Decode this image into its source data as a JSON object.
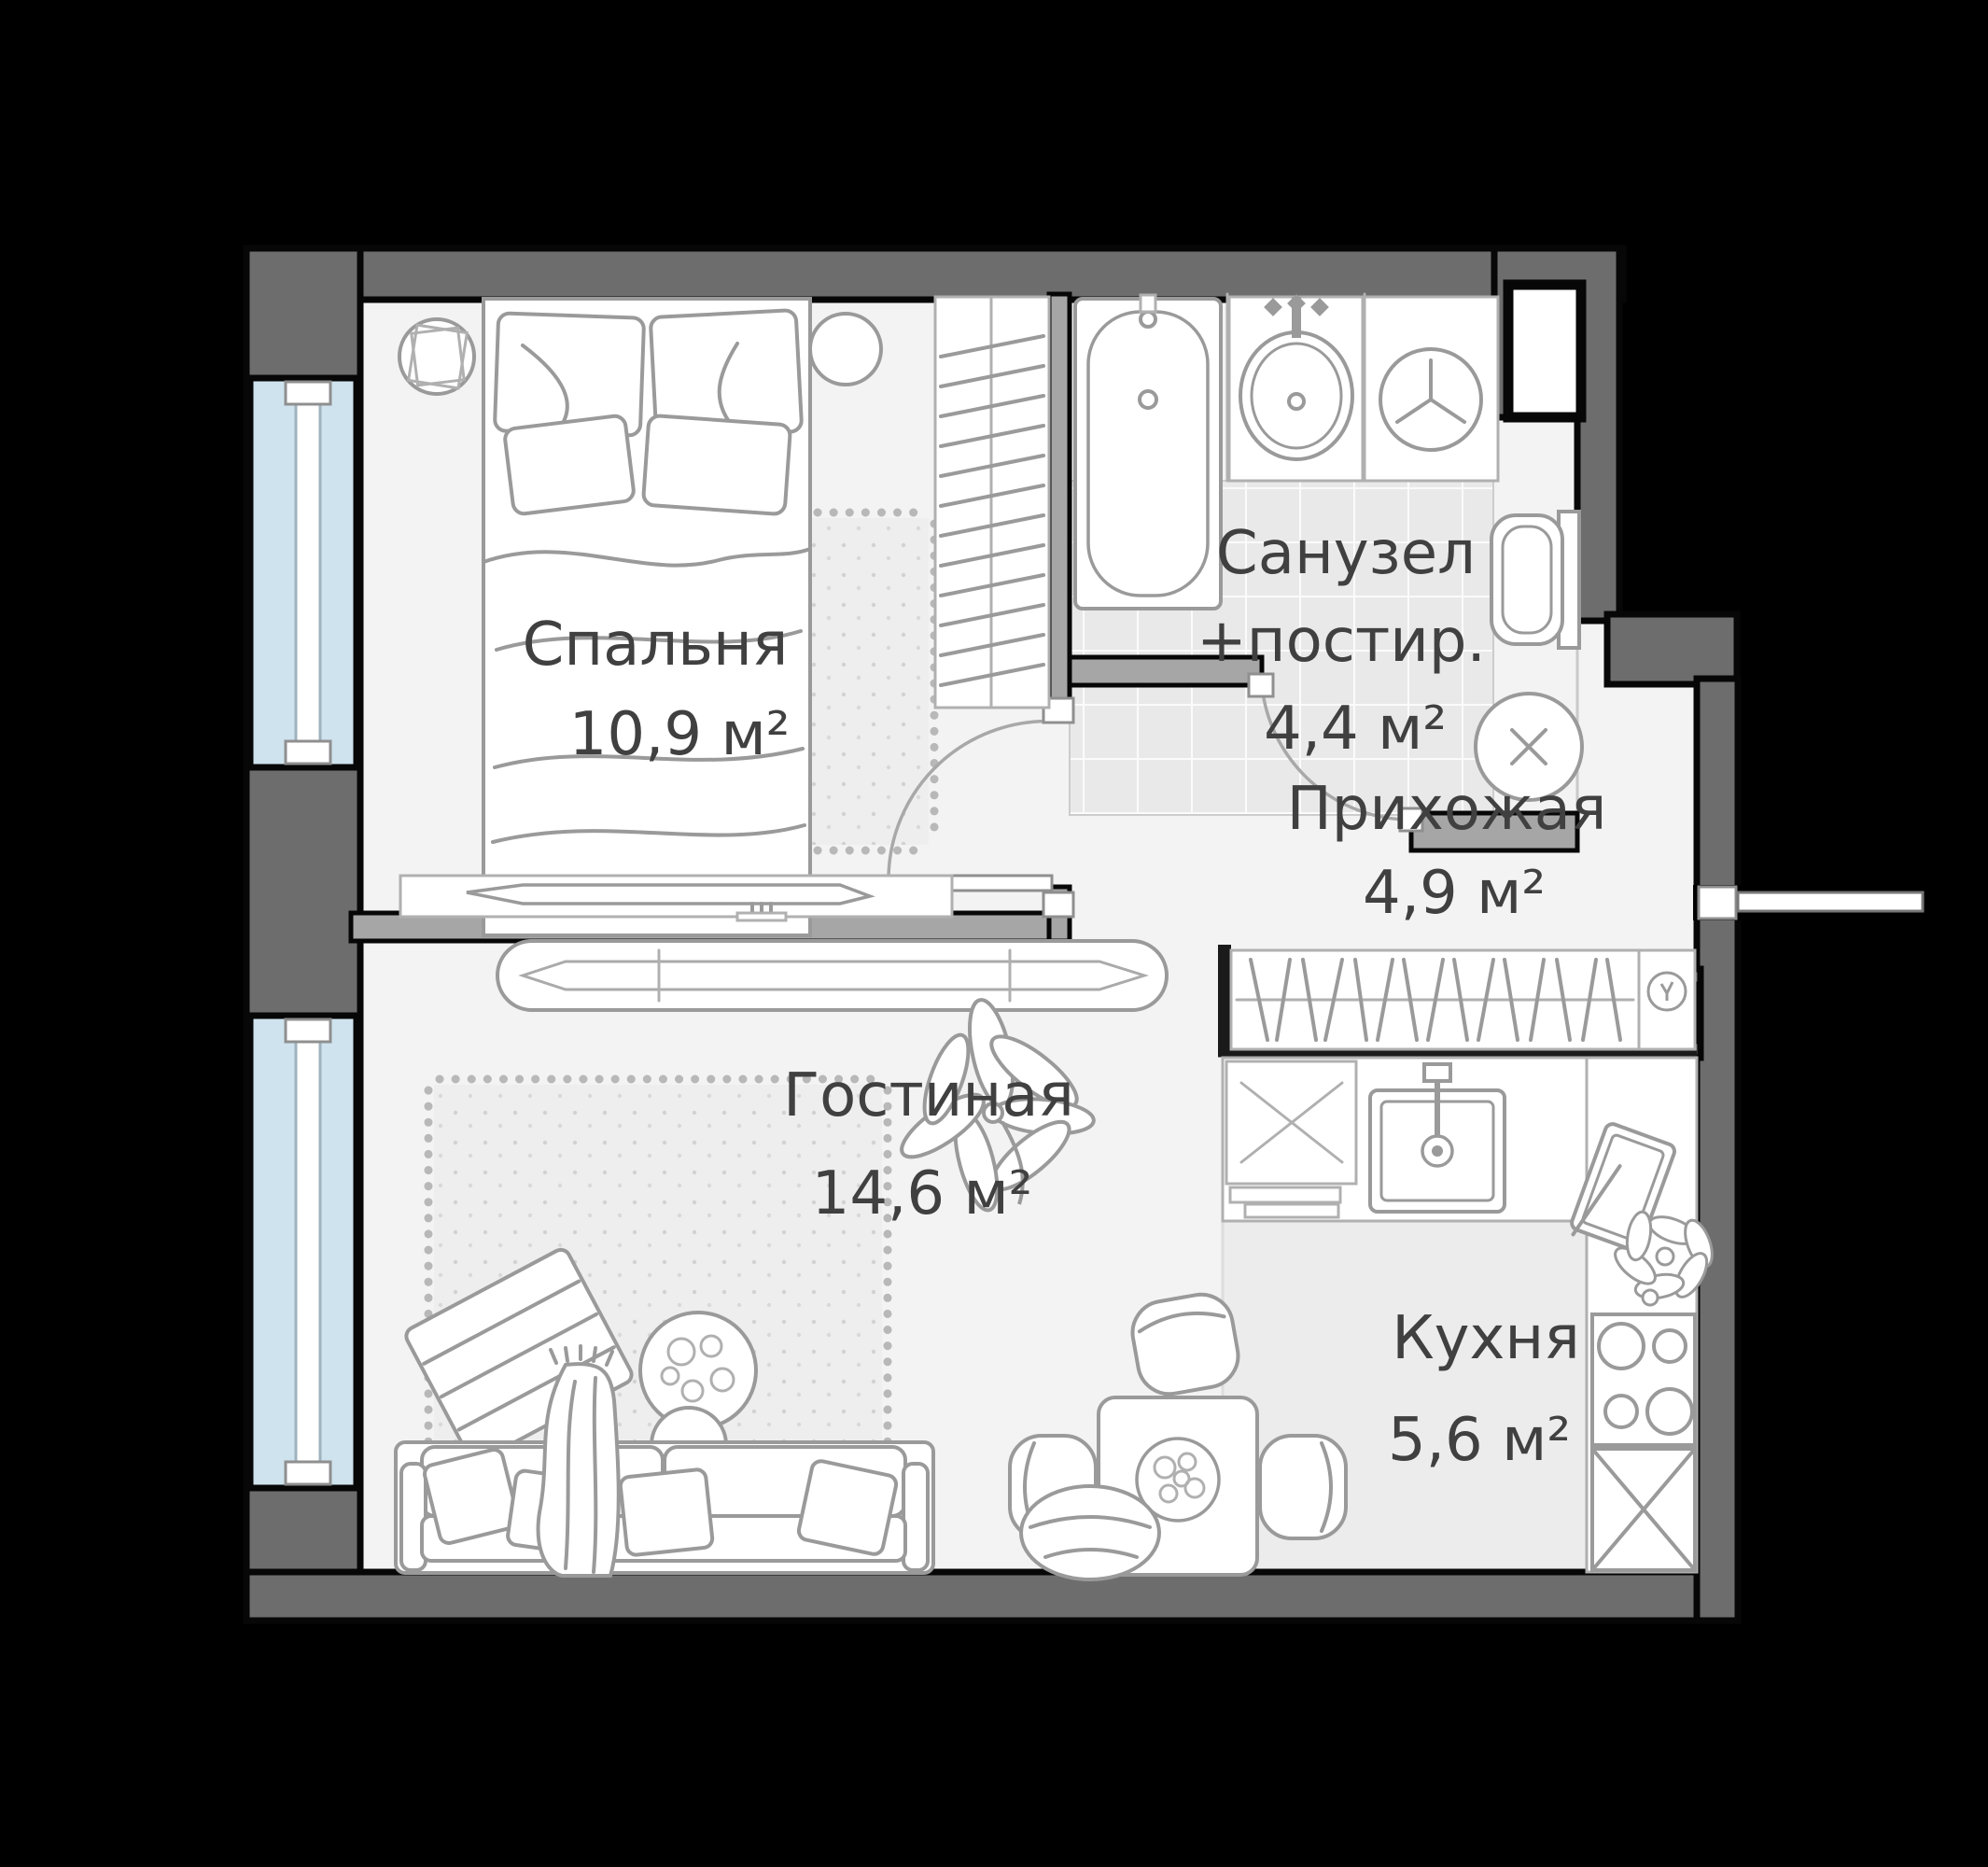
{
  "plan": {
    "title": "1-room apartment floor plan",
    "rooms": [
      {
        "id": "bedroom",
        "label": "Спальня",
        "area": "10,9 м²"
      },
      {
        "id": "bathroom",
        "label": "Санузел",
        "label2": "+постир.",
        "area": "4,4 м²"
      },
      {
        "id": "hallway",
        "label": "Прихожая",
        "area": "4,9 м²"
      },
      {
        "id": "living",
        "label": "Гостиная",
        "area": "14,6 м²"
      },
      {
        "id": "kitchen",
        "label": "Кухня",
        "area": "5,6 м²"
      }
    ],
    "icons": {
      "ceiling-light": "circle-with-x",
      "washing-machine": "circle-with-y-drum",
      "coat-hook": "small-circle-hanger",
      "stove": "four-burner-circles",
      "sink-bath": "oval-basin",
      "sink-kitchen": "square-basin",
      "toilet": "bowl-with-tank",
      "bathtub": "rounded-tub"
    },
    "colors": {
      "background": "#000000",
      "wall": "#6d6d6d",
      "wall_inner": "#a6a6a6",
      "outline": "#070707",
      "floor": "#f3f3f3",
      "window_glass": "#cfe3ee",
      "bathroom_tile": "#e9e9e9",
      "furniture_stroke": "#9a9a9a",
      "label_text": "#404040"
    }
  }
}
